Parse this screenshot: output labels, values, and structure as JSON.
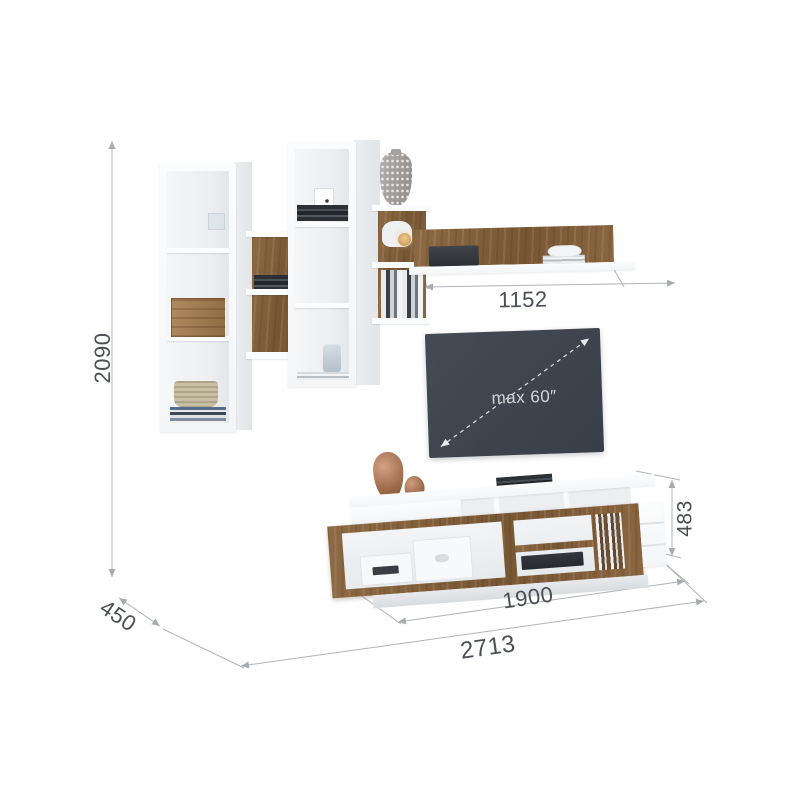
{
  "product_diagram": {
    "dimensions": {
      "total_height_mm": "2090",
      "depth_mm": "450",
      "total_width_mm": "2713",
      "tv_stand_width_mm": "1900",
      "tv_stand_height_mm": "483",
      "wall_shelf_width_mm": "1152"
    },
    "tv": {
      "max_size_label": "max 60″"
    },
    "colors": {
      "background": "#ffffff",
      "wood": "#81603d",
      "white_furniture": "#f8f9fa",
      "tv_screen": "#3e434d",
      "dimension_line": "#b0b3b7",
      "dimension_text": "#4b4e53",
      "copper_vase": "#b5846a"
    }
  }
}
